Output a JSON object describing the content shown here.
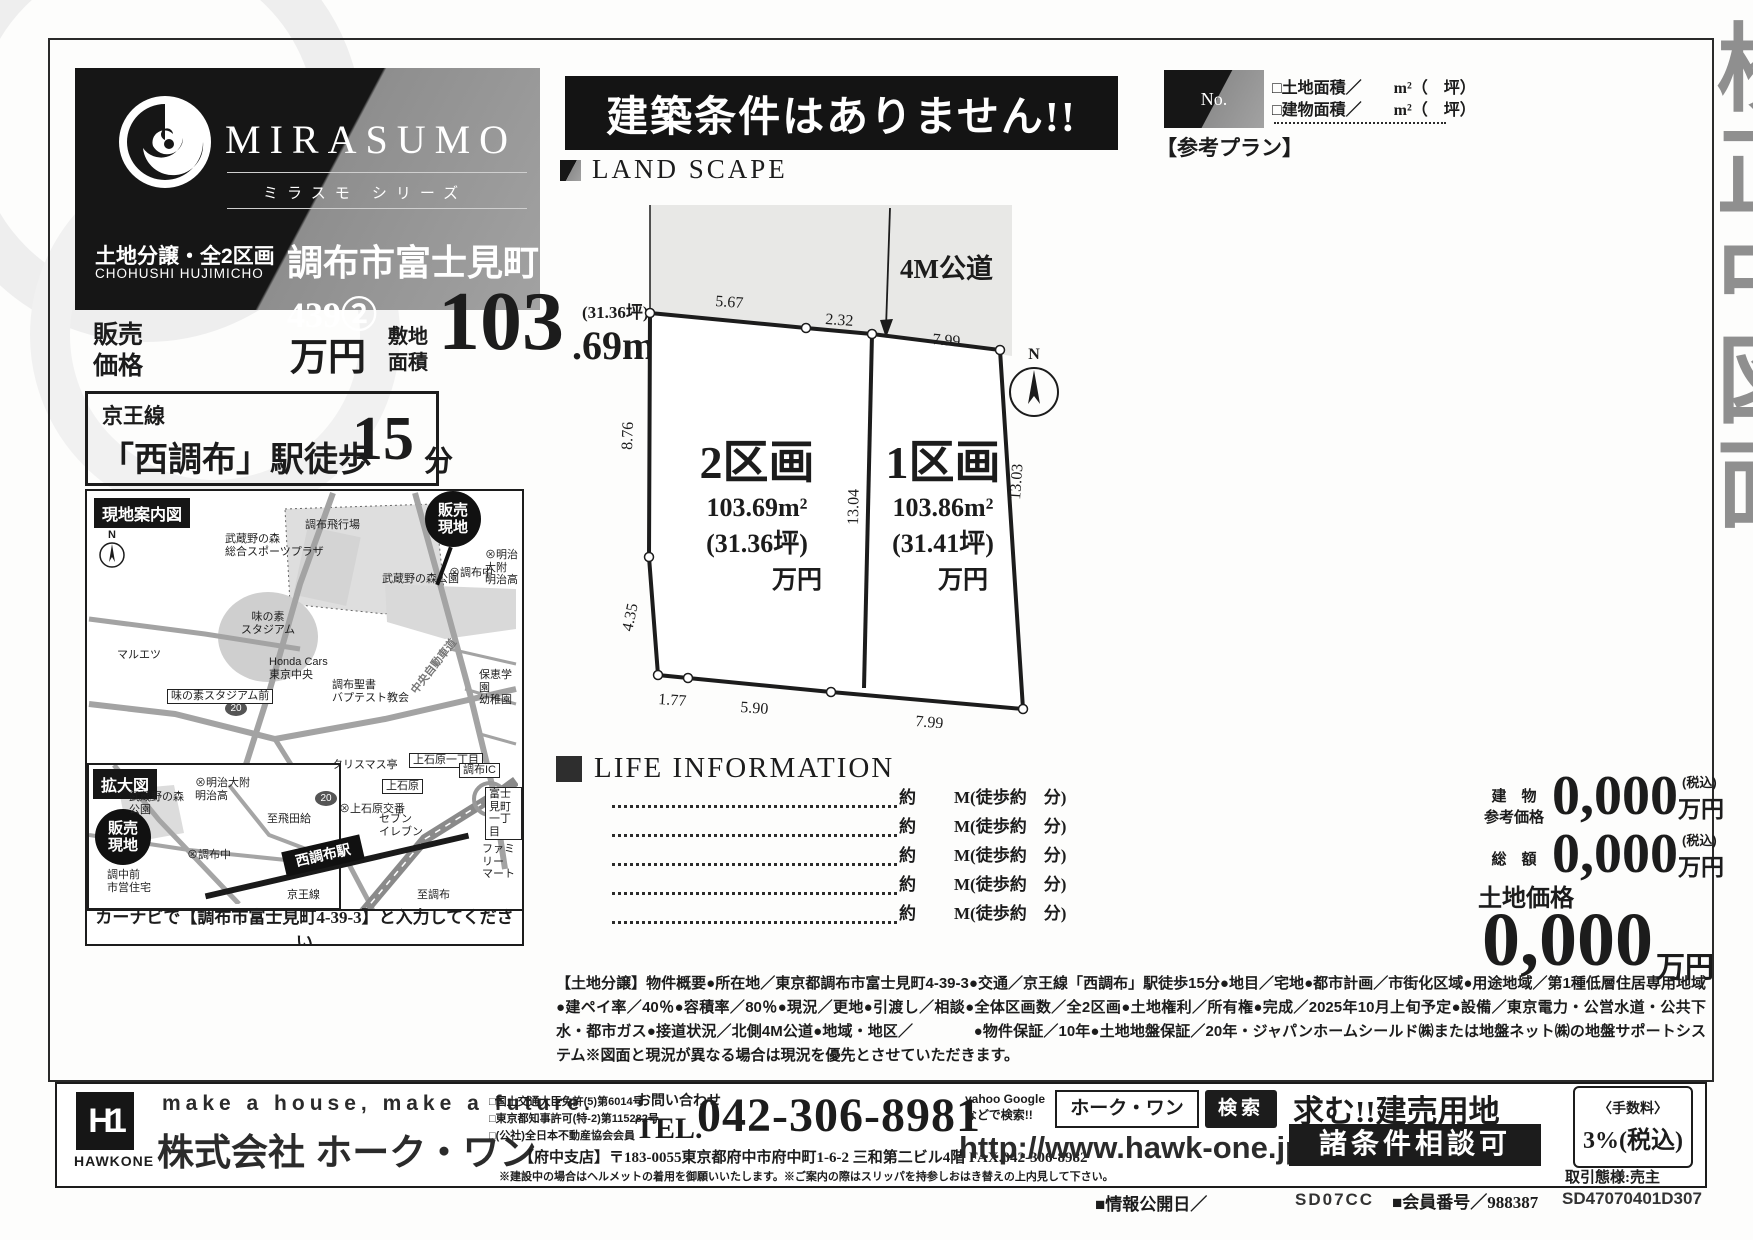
{
  "watermark": "校正中図面",
  "header": {
    "brand": "MIRASUMO",
    "brand_sub": "ミラスモ シリーズ",
    "sale_type": "土地分譲・全2区画",
    "romaji": "CHOHUSHI HUJIMICHO",
    "property": "調布市富士見町439②"
  },
  "banner": "建築条件はありません!!",
  "price": {
    "label": "販売\n価格",
    "unit": "万円",
    "area_label": "敷地\n面積",
    "area_int": "103",
    "area_dec": ".69m²",
    "tsubo": "(31.36坪)",
    "yori": "より"
  },
  "station": {
    "line": "京王線",
    "name": "「西調布」駅徒歩",
    "min": "15",
    "suffix": "分"
  },
  "refplan": {
    "no": "No.",
    "title": "【参考プラン】",
    "line1": "□土地面積／　　m²（　坪）",
    "line2": "□建物面積／　　m²（　坪）"
  },
  "landscape": {
    "title": "LAND SCAPE",
    "road": "4M公道",
    "compass": "N",
    "dims": {
      "t1": "5.67",
      "t2": "2.32",
      "t3": "7.99",
      "l1": "8.76",
      "l2": "4.35",
      "c1": "13.04",
      "r1": "13.03",
      "b1": "1.77",
      "b2": "5.90",
      "b3": "7.99"
    },
    "lot2": {
      "name": "2区画",
      "area": "103.69m²",
      "tsubo": "(31.36坪)",
      "price": "万円"
    },
    "lot1": {
      "name": "1区画",
      "area": "103.86m²",
      "tsubo": "(31.41坪)",
      "price": "万円"
    }
  },
  "life": {
    "title": "LIFE INFORMATION",
    "yaku": "約",
    "walk": "M(徒歩約　分)"
  },
  "prices": {
    "bld_l1": "建　物",
    "bld_l2": "参考価格",
    "bld_v": "0,000",
    "tax": "(税込)",
    "unit": "万円",
    "total_l": "総　額",
    "total_v": "0,000",
    "land_l": "土地価格",
    "land_v": "0,000"
  },
  "outline": "【土地分譲】物件概要●所在地／東京都調布市富士見町4-39-3●交通／京王線「西調布」駅徒歩15分●地目／宅地●都市計画／市街化区域●用途地域／第1種低層住居専用地域●建ペイ率／40％●容積率／80％●現況／更地●引渡し／相談●全体区画数／全2区画●土地権利／所有権●完成／2025年10月上旬予定●設備／東京電力・公営水道・公共下水・都市ガス●接道状況／北側4M公道●地域・地区／　　　　●物件保証／10年●土地地盤保証／20年・ジャパンホームシールド㈱または地盤ネット㈱の地盤サポートシステム※図面と現況が異なる場合は現況を優先とさせていただきます。",
  "map": {
    "guide": "現地案内図",
    "enlarge": "拡大図",
    "n": "N",
    "sell": "販売\n現地",
    "navi": "カーナビで【調布市富士見町4-39-3】と入力してください",
    "labels": {
      "airport": "調布飛行場",
      "sports": "武蔵野の森\n総合スポーツプラザ",
      "park1": "武蔵野の森公園",
      "meiji": "⊗明治大附\n明治高",
      "chofuchu": "⊗調布中",
      "stadium": "味の素\nスタジアム",
      "maruetsu": "マルエツ",
      "honda": "Honda Cars\n東京中央",
      "sta_mae": "味の素スタジアム前",
      "church": "調布聖書\nバプテスト教会",
      "hoiku": "保恵学園\n幼稚園",
      "expwy": "中央自動車道",
      "r20": "20",
      "park2": "武蔵野の森\n公園",
      "xmas": "クリスマス亭",
      "kamiishihara1": "上石原一丁目",
      "kamiishihara": "上石原",
      "chofuic": "調布IC",
      "fujimicho": "富士見町\n一丁目",
      "tobitakyu": "至飛田給",
      "koban": "⊗上石原交番",
      "seven": "セブン\nイレブン",
      "family": "ファミリー\nマート",
      "shiei": "調中前\n市営住宅",
      "nishichofu": "西調布駅",
      "keio": "京王線",
      "chofu": "至調布"
    }
  },
  "footer": {
    "logo": "HAWKONE",
    "logo_mark": "H1",
    "slogan": "make a house, make a future.",
    "company": "株式会社 ホーク・ワン",
    "lic1": "□国土交通大臣免許(5)第6014号",
    "lic2": "□東京都知事許可(特-2)第115282号",
    "lic3": "□(公社)全日本不動産協会会員",
    "contact": "お問い合わせ",
    "tel_label": "TEL.",
    "tel": "042-306-8981",
    "branch": "【府中支店】〒183-0055東京都府中市府中町1-6-2 三和第二ビル4階 FAX.042-306-8982",
    "note": "※建設中の場合はヘルメットの着用を御願いいたします。※ご案内の際はスリッパを持参しおはき替えの上内見して下さい。",
    "search_note": "yahoo Google\nなどで検索!!",
    "search_word": "ホーク・ワン",
    "search_btn": "検索",
    "url": "http://www.hawk-one.jp/",
    "wanted": "求む!!建売用地",
    "nego": "諸条件相談可",
    "fee_label": "〈手数料〉",
    "fee": "3%(税込)",
    "deal": "取引態様:売主"
  },
  "codes": {
    "date": "■情報公開日／",
    "c1": "SD07CC",
    "member": "■会員番号／988387",
    "c2": "SD47070401D307"
  }
}
